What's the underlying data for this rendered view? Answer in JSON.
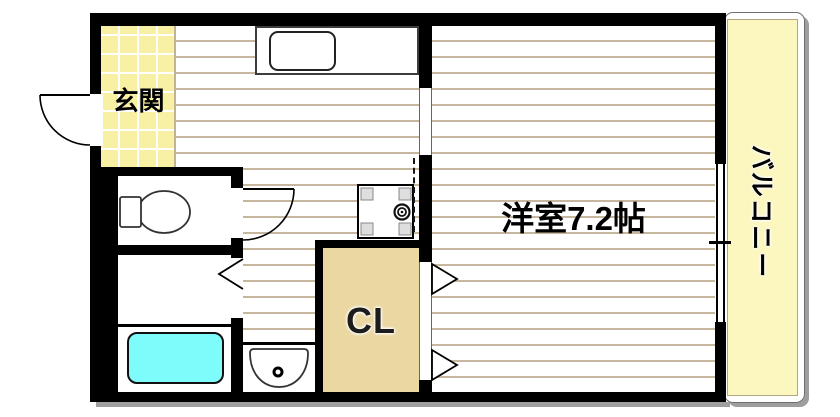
{
  "floorplan": {
    "labels": {
      "genkan": "玄関",
      "closet": "CL",
      "western_room": "洋室7.2帖",
      "balcony": "バルコニー"
    },
    "colors": {
      "wall": "#000000",
      "genkan_floor": "#f8f1a4",
      "balcony_floor": "#fcf6bf",
      "closet_floor": "#ead7a2",
      "bathtub": "#7efcfc",
      "floor_stripe": "#c7b79e",
      "shadow": "#9e9e9e"
    },
    "fixtures": [
      "entrance-door",
      "toilet",
      "toilet-door",
      "bath-folding-door",
      "bathtub",
      "washbasin",
      "washing-machine-pan",
      "kitchen-counter",
      "kitchen-sink",
      "sliding-door-opening",
      "closet-folding-doors",
      "balcony-window"
    ]
  }
}
